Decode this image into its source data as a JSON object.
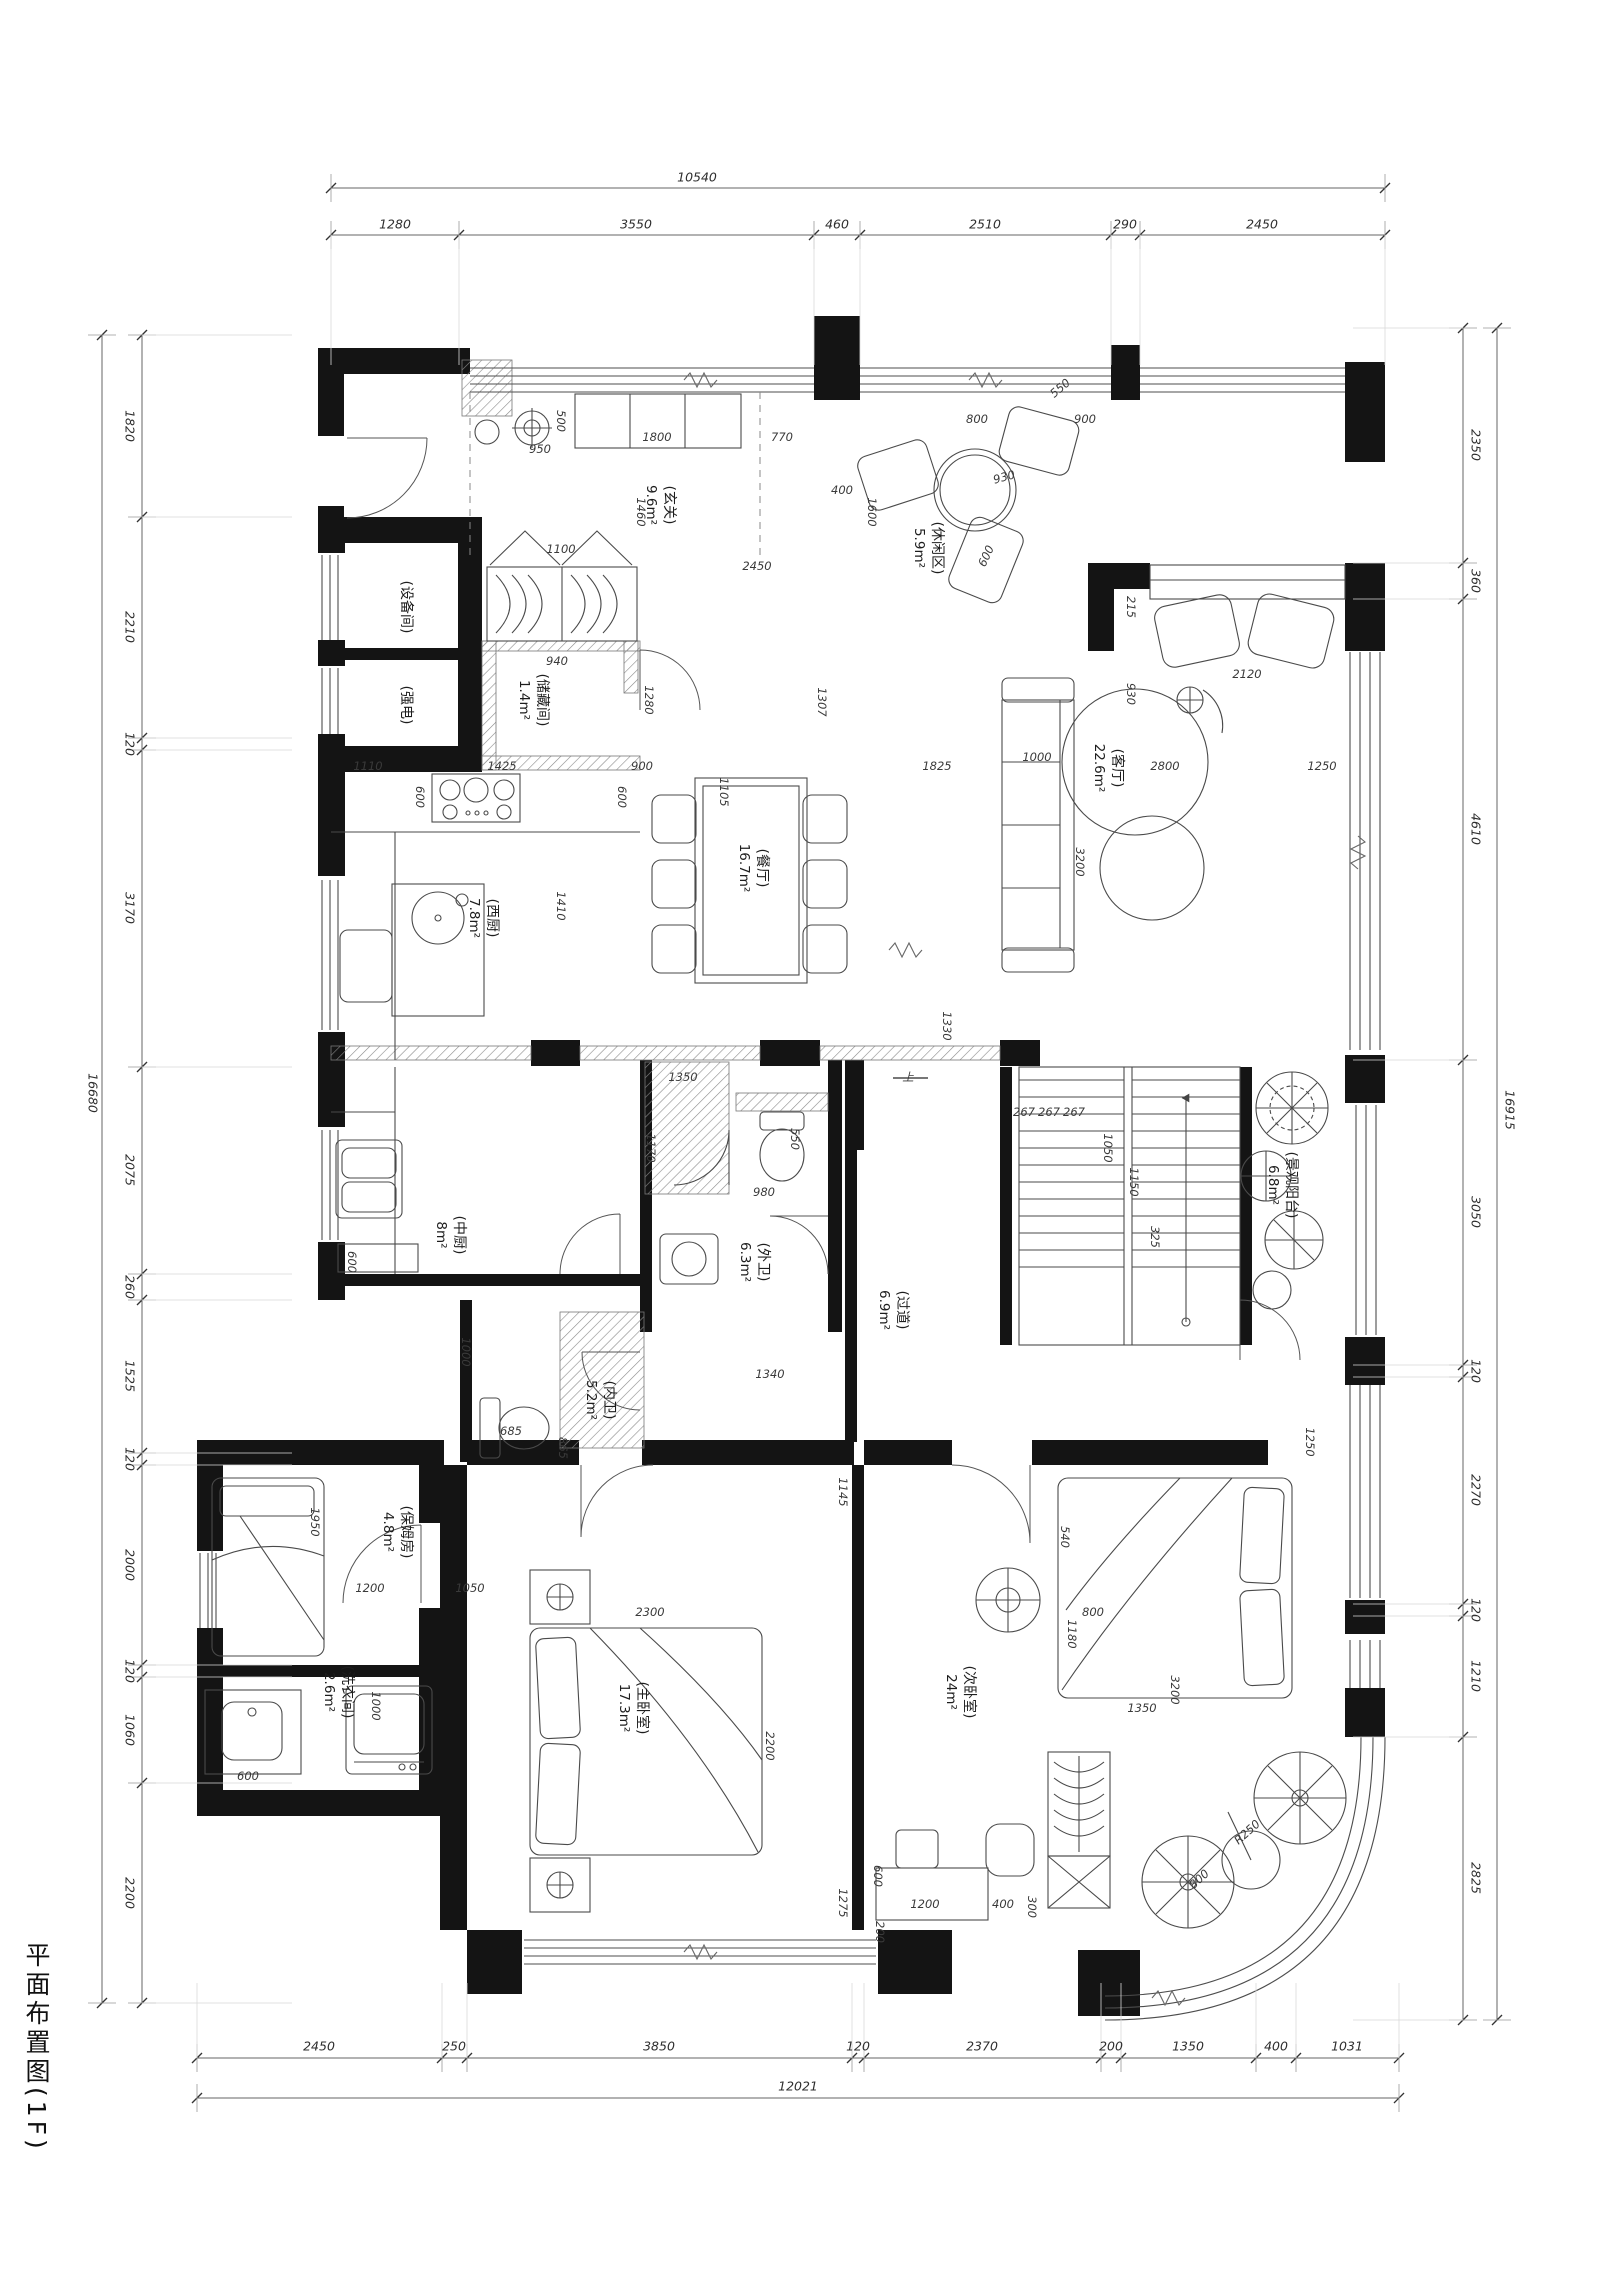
{
  "title": "平面布置图(1F)",
  "rooms": [
    {
      "id": "entry",
      "name": "(玄关)",
      "area": "9.6m²",
      "x": 660,
      "y": 505
    },
    {
      "id": "leisure",
      "name": "(休闲区)",
      "area": "5.9m²",
      "x": 928,
      "y": 548
    },
    {
      "id": "living",
      "name": "(客厅)",
      "area": "22.6m²",
      "x": 1108,
      "y": 768
    },
    {
      "id": "dining",
      "name": "(餐厅)",
      "area": "16.7m²",
      "x": 753,
      "y": 868
    },
    {
      "id": "west-kitchen",
      "name": "(西厨)",
      "area": "7.8m²",
      "x": 483,
      "y": 918
    },
    {
      "id": "storage",
      "name": "(储藏间)",
      "area": "1.4m²",
      "x": 533,
      "y": 700
    },
    {
      "id": "equipment",
      "name": "(设备间)",
      "area": "",
      "x": 405,
      "y": 607
    },
    {
      "id": "electrical",
      "name": "(强电)",
      "area": "",
      "x": 405,
      "y": 705
    },
    {
      "id": "chinese-kitchen",
      "name": "(中厨)",
      "area": "8m²",
      "x": 450,
      "y": 1235
    },
    {
      "id": "outer-bath",
      "name": "(外卫)",
      "area": "6.3m²",
      "x": 754,
      "y": 1262
    },
    {
      "id": "inner-bath",
      "name": "(内卫)",
      "area": "5.2m²",
      "x": 600,
      "y": 1400
    },
    {
      "id": "corridor",
      "name": "(过道)",
      "area": "6.9m²",
      "x": 893,
      "y": 1310
    },
    {
      "id": "nanny-room",
      "name": "(保姆房)",
      "area": "4.8m²",
      "x": 397,
      "y": 1532
    },
    {
      "id": "laundry",
      "name": "(洗衣间)",
      "area": "2.6m²",
      "x": 338,
      "y": 1692
    },
    {
      "id": "master-bedroom",
      "name": "(主卧室)",
      "area": "17.3m²",
      "x": 633,
      "y": 1708
    },
    {
      "id": "second-bedroom",
      "name": "(次卧室)",
      "area": "24m²",
      "x": 960,
      "y": 1692
    },
    {
      "id": "view-balcony",
      "name": "(景观阳台)",
      "area": "6.8m²",
      "x": 1282,
      "y": 1185
    }
  ],
  "chains": [
    {
      "o": "h",
      "pos": 188,
      "a": 331,
      "b": 1385,
      "ticks": [
        331,
        1385
      ],
      "off": -11,
      "ext": 0,
      "labels": [
        {
          "t": "10540",
          "p": 697
        }
      ]
    },
    {
      "o": "h",
      "pos": 235,
      "a": 331,
      "b": 1385,
      "ticks": [
        331,
        459,
        814,
        860,
        1111,
        1140,
        1385
      ],
      "off": -11,
      "ext": 130,
      "labels": [
        {
          "t": "1280",
          "p": 395
        },
        {
          "t": "3550",
          "p": 636
        },
        {
          "t": "460",
          "p": 837
        },
        {
          "t": "2510",
          "p": 985
        },
        {
          "t": "290",
          "p": 1125
        },
        {
          "t": "2450",
          "p": 1262
        }
      ]
    },
    {
      "o": "h",
      "pos": 2058,
      "a": 197,
      "b": 1399,
      "ticks": [
        197,
        442,
        467,
        852,
        864,
        1101,
        1121,
        1256,
        1296,
        1399
      ],
      "off": -12,
      "ext": -75,
      "labels": [
        {
          "t": "2450",
          "p": 319
        },
        {
          "t": "250",
          "p": 454
        },
        {
          "t": "3850",
          "p": 659
        },
        {
          "t": "120",
          "p": 858
        },
        {
          "t": "2370",
          "p": 982
        },
        {
          "t": "200",
          "p": 1111
        },
        {
          "t": "1350",
          "p": 1188
        },
        {
          "t": "400",
          "p": 1276
        },
        {
          "t": "1031",
          "p": 1347
        }
      ]
    },
    {
      "o": "h",
      "pos": 2098,
      "a": 197,
      "b": 1399,
      "ticks": [
        197,
        1399
      ],
      "off": -12,
      "ext": 0,
      "labels": [
        {
          "t": "12021",
          "p": 798
        }
      ]
    },
    {
      "o": "v",
      "pos": 142,
      "a": 335,
      "b": 2003,
      "ticks": [
        335,
        517,
        738,
        750,
        1067,
        1274,
        1300,
        1453,
        1465,
        1665,
        1677,
        1783,
        2003
      ],
      "off": -12,
      "ext": 150,
      "labels": [
        {
          "t": "1820",
          "p": 426
        },
        {
          "t": "2210",
          "p": 627
        },
        {
          "t": "120",
          "p": 744
        },
        {
          "t": "3170",
          "p": 908
        },
        {
          "t": "2075",
          "p": 1170
        },
        {
          "t": "260",
          "p": 1287
        },
        {
          "t": "1525",
          "p": 1376
        },
        {
          "t": "120",
          "p": 1459
        },
        {
          "t": "2000",
          "p": 1565
        },
        {
          "t": "120",
          "p": 1671
        },
        {
          "t": "1060",
          "p": 1730
        },
        {
          "t": "2200",
          "p": 1893
        }
      ]
    },
    {
      "o": "v",
      "pos": 102,
      "a": 335,
      "b": 2003,
      "ticks": [
        335,
        2003
      ],
      "off": -9,
      "ext": 0,
      "labels": [
        {
          "t": "16680",
          "p": 1093
        }
      ]
    },
    {
      "o": "v",
      "pos": 1463,
      "a": 328,
      "b": 2020,
      "ticks": [
        328,
        563,
        599,
        1060,
        1365,
        1377,
        1604,
        1616,
        1737,
        2020
      ],
      "off": 13,
      "ext": -110,
      "labels": [
        {
          "t": "2350",
          "p": 445
        },
        {
          "t": "360",
          "p": 581
        },
        {
          "t": "4610",
          "p": 829
        },
        {
          "t": "3050",
          "p": 1212
        },
        {
          "t": "120",
          "p": 1371
        },
        {
          "t": "2270",
          "p": 1490
        },
        {
          "t": "120",
          "p": 1610
        },
        {
          "t": "1210",
          "p": 1676
        },
        {
          "t": "2825",
          "p": 1878
        }
      ]
    },
    {
      "o": "v",
      "pos": 1497,
      "a": 328,
      "b": 2020,
      "ticks": [
        328,
        2020
      ],
      "off": 13,
      "ext": 0,
      "labels": [
        {
          "t": "16915",
          "p": 1110
        }
      ]
    }
  ],
  "inline_dims": [
    {
      "t": "950",
      "x": 540,
      "y": 449,
      "r": 0
    },
    {
      "t": "500",
      "x": 561,
      "y": 421,
      "r": 90
    },
    {
      "t": "1800",
      "x": 657,
      "y": 437,
      "r": 0
    },
    {
      "t": "770",
      "x": 782,
      "y": 437,
      "r": 0
    },
    {
      "t": "1460",
      "x": 641,
      "y": 512,
      "r": 90
    },
    {
      "t": "2450",
      "x": 757,
      "y": 566,
      "r": 0
    },
    {
      "t": "400",
      "x": 842,
      "y": 490,
      "r": 0
    },
    {
      "t": "1600",
      "x": 872,
      "y": 512,
      "r": 90
    },
    {
      "t": "930",
      "x": 1004,
      "y": 477,
      "r": -15
    },
    {
      "t": "800",
      "x": 977,
      "y": 419,
      "r": 0
    },
    {
      "t": "900",
      "x": 1085,
      "y": 419,
      "r": 0
    },
    {
      "t": "550",
      "x": 1060,
      "y": 388,
      "r": -40
    },
    {
      "t": "600",
      "x": 986,
      "y": 556,
      "r": -65
    },
    {
      "t": "215",
      "x": 1131,
      "y": 607,
      "r": 90
    },
    {
      "t": "930",
      "x": 1131,
      "y": 694,
      "r": 90
    },
    {
      "t": "2120",
      "x": 1247,
      "y": 674,
      "r": 0
    },
    {
      "t": "1307",
      "x": 822,
      "y": 702,
      "r": 90
    },
    {
      "t": "1100",
      "x": 561,
      "y": 549,
      "r": 0
    },
    {
      "t": "940",
      "x": 557,
      "y": 661,
      "r": 0
    },
    {
      "t": "1280",
      "x": 649,
      "y": 700,
      "r": 90
    },
    {
      "t": "600",
      "x": 420,
      "y": 797,
      "r": 90
    },
    {
      "t": "600",
      "x": 622,
      "y": 797,
      "r": 90
    },
    {
      "t": "1410",
      "x": 561,
      "y": 906,
      "r": 90
    },
    {
      "t": "1110",
      "x": 368,
      "y": 766,
      "r": 0
    },
    {
      "t": "1425",
      "x": 502,
      "y": 766,
      "r": 0
    },
    {
      "t": "900",
      "x": 642,
      "y": 766,
      "r": 0
    },
    {
      "t": "1105",
      "x": 724,
      "y": 792,
      "r": 90
    },
    {
      "t": "1825",
      "x": 937,
      "y": 766,
      "r": 0
    },
    {
      "t": "2800",
      "x": 1165,
      "y": 766,
      "r": 0
    },
    {
      "t": "1250",
      "x": 1322,
      "y": 766,
      "r": 0
    },
    {
      "t": "1000",
      "x": 1037,
      "y": 757,
      "r": 0
    },
    {
      "t": "3200",
      "x": 1080,
      "y": 862,
      "r": 90
    },
    {
      "t": "1330",
      "x": 947,
      "y": 1026,
      "r": 90
    },
    {
      "t": "267",
      "x": 1024,
      "y": 1112,
      "r": 0
    },
    {
      "t": "267",
      "x": 1049,
      "y": 1112,
      "r": 0
    },
    {
      "t": "267",
      "x": 1074,
      "y": 1112,
      "r": 0
    },
    {
      "t": "1050",
      "x": 1108,
      "y": 1148,
      "r": 90
    },
    {
      "t": "1150",
      "x": 1134,
      "y": 1182,
      "r": 90
    },
    {
      "t": "325",
      "x": 1155,
      "y": 1237,
      "r": 90
    },
    {
      "t": "上",
      "x": 908,
      "y": 1077,
      "r": 0
    },
    {
      "t": "1350",
      "x": 683,
      "y": 1077,
      "r": 0
    },
    {
      "t": "1170",
      "x": 651,
      "y": 1148,
      "r": 90
    },
    {
      "t": "980",
      "x": 764,
      "y": 1192,
      "r": 0
    },
    {
      "t": "550",
      "x": 795,
      "y": 1139,
      "r": 90
    },
    {
      "t": "1340",
      "x": 770,
      "y": 1374,
      "r": 0
    },
    {
      "t": "685",
      "x": 511,
      "y": 1431,
      "r": 0
    },
    {
      "t": "865",
      "x": 563,
      "y": 1448,
      "r": 90
    },
    {
      "t": "1000",
      "x": 466,
      "y": 1352,
      "r": 90
    },
    {
      "t": "600",
      "x": 352,
      "y": 1262,
      "r": 90
    },
    {
      "t": "1950",
      "x": 315,
      "y": 1522,
      "r": 90
    },
    {
      "t": "1200",
      "x": 370,
      "y": 1588,
      "r": 0
    },
    {
      "t": "1050",
      "x": 470,
      "y": 1588,
      "r": 0
    },
    {
      "t": "1000",
      "x": 376,
      "y": 1706,
      "r": 90
    },
    {
      "t": "600",
      "x": 248,
      "y": 1776,
      "r": 0
    },
    {
      "t": "2300",
      "x": 650,
      "y": 1612,
      "r": 0
    },
    {
      "t": "2200",
      "x": 770,
      "y": 1746,
      "r": 90
    },
    {
      "t": "1145",
      "x": 843,
      "y": 1492,
      "r": 90
    },
    {
      "t": "1275",
      "x": 843,
      "y": 1903,
      "r": 90
    },
    {
      "t": "800",
      "x": 1093,
      "y": 1612,
      "r": 0
    },
    {
      "t": "3200",
      "x": 1175,
      "y": 1690,
      "r": 90
    },
    {
      "t": "1250",
      "x": 1310,
      "y": 1442,
      "r": 90
    },
    {
      "t": "540",
      "x": 1065,
      "y": 1537,
      "r": 90
    },
    {
      "t": "1180",
      "x": 1072,
      "y": 1634,
      "r": 90
    },
    {
      "t": "1350",
      "x": 1142,
      "y": 1708,
      "r": 0
    },
    {
      "t": "1200",
      "x": 925,
      "y": 1904,
      "r": 0
    },
    {
      "t": "400",
      "x": 1003,
      "y": 1904,
      "r": 0
    },
    {
      "t": "300",
      "x": 1032,
      "y": 1907,
      "r": 90
    },
    {
      "t": "600",
      "x": 878,
      "y": 1876,
      "r": 90
    },
    {
      "t": "200",
      "x": 880,
      "y": 1932,
      "r": 90
    },
    {
      "t": "800",
      "x": 1199,
      "y": 1879,
      "r": -42
    },
    {
      "t": "R250",
      "x": 1247,
      "y": 1832,
      "r": -42
    }
  ]
}
